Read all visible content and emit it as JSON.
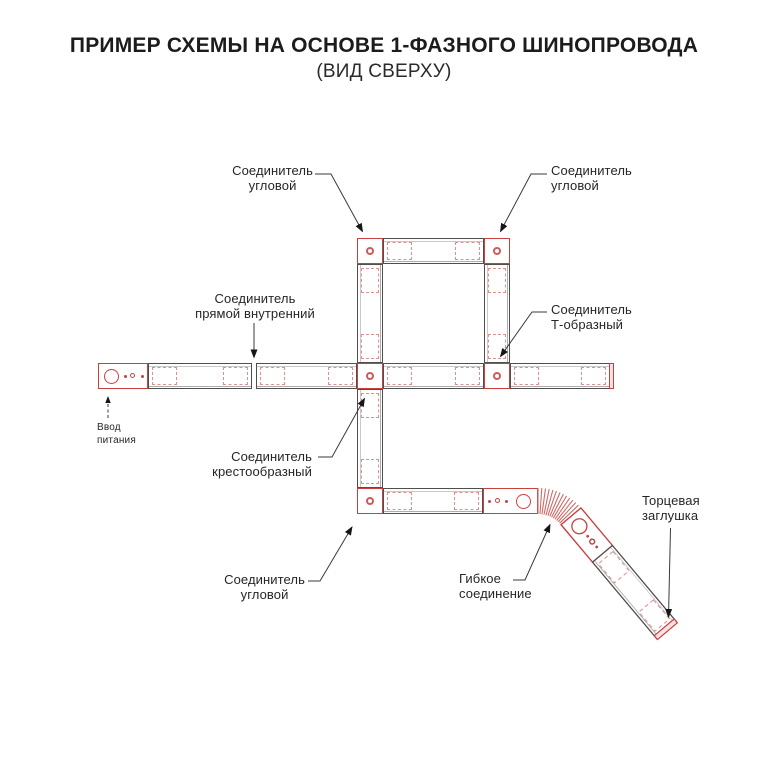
{
  "header": {
    "title": "ПРИМЕР СХЕМЫ НА ОСНОВЕ 1-ФАЗНОГО ШИНОПРОВОДА",
    "subtitle": "(ВИД СВЕРХУ)"
  },
  "diagram": {
    "labels": {
      "corner_top_left": "Соединитель\nугловой",
      "corner_top_right": "Соединитель\nугловой",
      "straight_internal": "Соединитель\nпрямой внутренний",
      "t_shaped": "Соединитель\nТ-образный",
      "cross_shaped": "Соединитель\nкрестообразный",
      "corner_bottom": "Соединитель\nугловой",
      "power_input": "Ввод\nпитания",
      "flexible": "Гибкое\nсоединение",
      "end_cap": "Торцевая\nзаглушка"
    },
    "colors": {
      "accent_red": "#c8413f",
      "dashed_red": "#dc8f8d",
      "track_outline": "#4f4f4f",
      "leader_line": "#3a3a3a",
      "text": "#262626"
    }
  }
}
